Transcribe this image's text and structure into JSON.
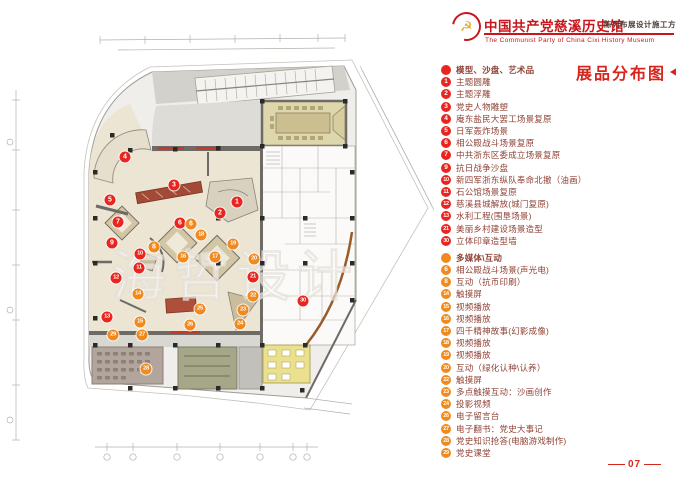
{
  "header": {
    "logo": "party-emblem-icon",
    "title": "中国共产党慈溪历史馆",
    "scheme": "陈列布展设计施工方案",
    "subtitle_en": "The Communist Party of China Cixi History Museum"
  },
  "legend": {
    "title": "展品分布图",
    "groups": [
      {
        "label": "模型、沙盘、艺术品",
        "dot_color": "#e8261f",
        "items": [
          {
            "num": "1",
            "label": "主题圆雕"
          },
          {
            "num": "2",
            "label": "主题浮雕"
          },
          {
            "num": "3",
            "label": "党史人物雕塑"
          },
          {
            "num": "4",
            "label": "庵东盐民大罢工场景复原"
          },
          {
            "num": "5",
            "label": "日军轰炸场景"
          },
          {
            "num": "6",
            "label": "相公殿战斗场景复原"
          },
          {
            "num": "7",
            "label": "中共浙东区委成立场景复原"
          },
          {
            "num": "9",
            "label": "抗日战争沙盘"
          },
          {
            "num": "10",
            "label": "新四军浙东纵队奉命北撤（油画）"
          },
          {
            "num": "11",
            "label": "石公馆场景复原"
          },
          {
            "num": "12",
            "label": "慈溪县城解放(城门复原)"
          },
          {
            "num": "13",
            "label": "水利工程(围垦场景)"
          },
          {
            "num": "21",
            "label": "美丽乡村建设场景造型"
          },
          {
            "num": "30",
            "label": "立体印章造型墙"
          }
        ]
      },
      {
        "label": "多媒体\\互动",
        "dot_color": "#f08a1e",
        "items": [
          {
            "num": "6",
            "label": "相公殿战斗场景(声光电)"
          },
          {
            "num": "8",
            "label": "互动（抗币印刷）"
          },
          {
            "num": "14",
            "label": "触摸屏"
          },
          {
            "num": "15",
            "label": "视频播放"
          },
          {
            "num": "16",
            "label": "视频播放"
          },
          {
            "num": "17",
            "label": "四千精神故事(幻影成像)"
          },
          {
            "num": "18",
            "label": "视频播放"
          },
          {
            "num": "19",
            "label": "视频播放"
          },
          {
            "num": "20",
            "label": "互动（绿化认种\\认养）"
          },
          {
            "num": "22",
            "label": "触摸屏"
          },
          {
            "num": "23",
            "label": "多点触摸互动：沙画创作"
          },
          {
            "num": "24",
            "label": "投影视频"
          },
          {
            "num": "26",
            "label": "电子留言台"
          },
          {
            "num": "27",
            "label": "电子翻书：党史大事记"
          },
          {
            "num": "28",
            "label": "党史知识抢答(电脑游戏制作)"
          },
          {
            "num": "29",
            "label": "党史课堂"
          }
        ]
      }
    ]
  },
  "plan": {
    "watermark": "海哲设计",
    "badge_colors": {
      "red": "#e8261f",
      "orange": "#f08a1e"
    },
    "badges": [
      {
        "num": "1",
        "group": "red",
        "x": 237,
        "y": 202
      },
      {
        "num": "2",
        "group": "red",
        "x": 220,
        "y": 213
      },
      {
        "num": "3",
        "group": "red",
        "x": 174,
        "y": 185
      },
      {
        "num": "4",
        "group": "red",
        "x": 125,
        "y": 157
      },
      {
        "num": "5",
        "group": "red",
        "x": 110,
        "y": 200
      },
      {
        "num": "6",
        "group": "red",
        "x": 180,
        "y": 223
      },
      {
        "num": "7",
        "group": "red",
        "x": 118,
        "y": 222
      },
      {
        "num": "9",
        "group": "red",
        "x": 112,
        "y": 243
      },
      {
        "num": "10",
        "group": "red",
        "x": 140,
        "y": 254
      },
      {
        "num": "11",
        "group": "red",
        "x": 139,
        "y": 268
      },
      {
        "num": "12",
        "group": "red",
        "x": 116,
        "y": 278
      },
      {
        "num": "13",
        "group": "red",
        "x": 107,
        "y": 317
      },
      {
        "num": "21",
        "group": "red",
        "x": 253,
        "y": 277
      },
      {
        "num": "30",
        "group": "red",
        "x": 303,
        "y": 301
      },
      {
        "num": "6",
        "group": "orange",
        "x": 191,
        "y": 224
      },
      {
        "num": "8",
        "group": "orange",
        "x": 154,
        "y": 247
      },
      {
        "num": "14",
        "group": "orange",
        "x": 138,
        "y": 294
      },
      {
        "num": "15",
        "group": "orange",
        "x": 140,
        "y": 322
      },
      {
        "num": "16",
        "group": "orange",
        "x": 183,
        "y": 257
      },
      {
        "num": "17",
        "group": "orange",
        "x": 215,
        "y": 257
      },
      {
        "num": "18",
        "group": "orange",
        "x": 201,
        "y": 235
      },
      {
        "num": "19",
        "group": "orange",
        "x": 233,
        "y": 244
      },
      {
        "num": "20",
        "group": "orange",
        "x": 254,
        "y": 259
      },
      {
        "num": "22",
        "group": "orange",
        "x": 253,
        "y": 296
      },
      {
        "num": "23",
        "group": "orange",
        "x": 243,
        "y": 310
      },
      {
        "num": "24",
        "group": "orange",
        "x": 240,
        "y": 324
      },
      {
        "num": "25",
        "group": "orange",
        "x": 200,
        "y": 309
      },
      {
        "num": "26",
        "group": "orange",
        "x": 190,
        "y": 325
      },
      {
        "num": "27",
        "group": "orange",
        "x": 142,
        "y": 335
      },
      {
        "num": "28",
        "group": "orange",
        "x": 146,
        "y": 369
      },
      {
        "num": "29",
        "group": "orange",
        "x": 113,
        "y": 335
      }
    ]
  },
  "footer": {
    "page_number": "07"
  }
}
